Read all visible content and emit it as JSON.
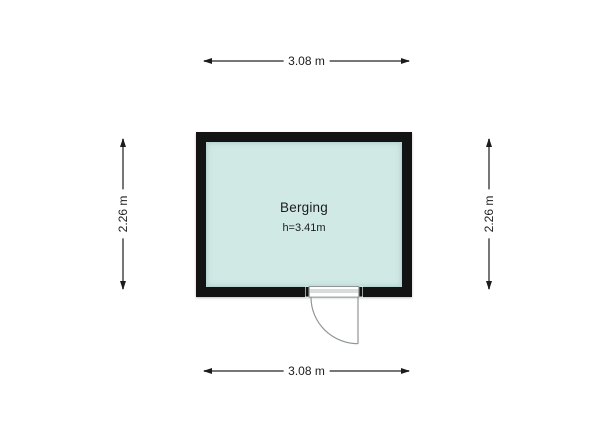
{
  "floorplan": {
    "room": {
      "name": "Berging",
      "height_label": "h=3.41m"
    },
    "dimensions": {
      "top_width": "3.08 m",
      "bottom_width": "3.08 m",
      "left_height": "2.26 m",
      "right_height": "2.26 m"
    },
    "colors": {
      "background": "#ffffff",
      "wall": "#131313",
      "room_fill": "#d0e9e5",
      "room_inner_edge": "#b7d6d1",
      "dimension_line": "#767676",
      "arrowhead": "#1c1c1c",
      "label_text": "#1c1c1c",
      "door_line": "#8f9698"
    }
  }
}
